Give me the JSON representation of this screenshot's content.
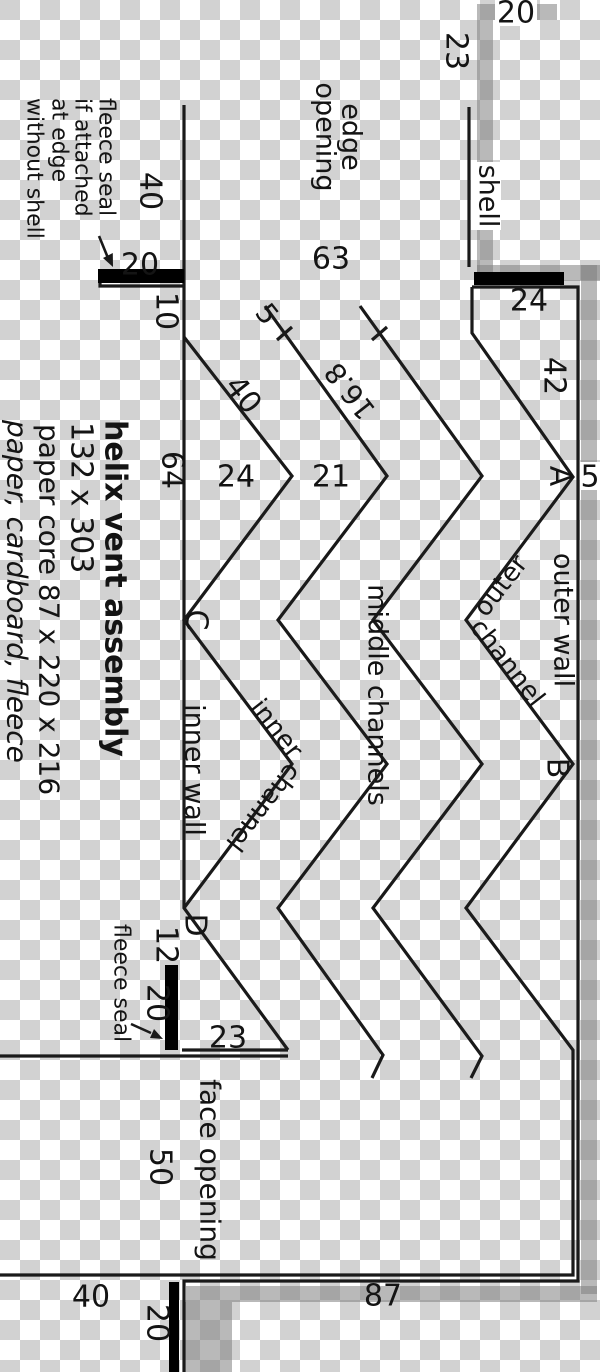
{
  "title_block": {
    "line1": "helix vent assembly",
    "line2": "132 x 303",
    "line3": "paper core 87 x 220 x 216",
    "line4": "paper, cardboard, fleece"
  },
  "fleece_note": {
    "l1": "fleece seal",
    "l2": "if attached",
    "l3": "at edge",
    "l4": "without shell"
  },
  "labels": {
    "shell": "shell",
    "edge_opening_l1": "edge",
    "edge_opening_l2": "opening",
    "face_opening": "face opening",
    "inner_wall": "inner wall",
    "outer_wall": "outer wall",
    "middle_channels": "middle channels",
    "inner_channel_w1": "inner",
    "inner_channel_w2": "channel",
    "outer_channel_w1": "outer",
    "outer_channel_w2": "channel",
    "fleece_seal": "fleece seal"
  },
  "points": {
    "A": "A",
    "B": "B",
    "C": "C",
    "D": "D"
  },
  "dims": {
    "shell_top_20": "20",
    "shell_23": "23",
    "seal_top_left_20": "20",
    "wall_top_40": "40",
    "edge_63": "63",
    "box_24": "24",
    "lip_10": "10",
    "diag_40": "40",
    "tick_5": "5",
    "diag_16_8": "16.8",
    "left_64": "64",
    "mid_24": "24",
    "mid_21": "21",
    "right_42": "42",
    "gap_5": "5",
    "d_12": "12",
    "seal_left_20": "20",
    "bottom_23": "23",
    "face_50": "50",
    "bottom_40": "40",
    "core_87": "87",
    "seal_bottom_20": "20"
  },
  "colors": {
    "checker_gray": "#d2d2d2",
    "line_black": "#1a1a1a",
    "shell_gray": "rgba(128,128,128,0.55)",
    "bar_black": "#000000"
  }
}
